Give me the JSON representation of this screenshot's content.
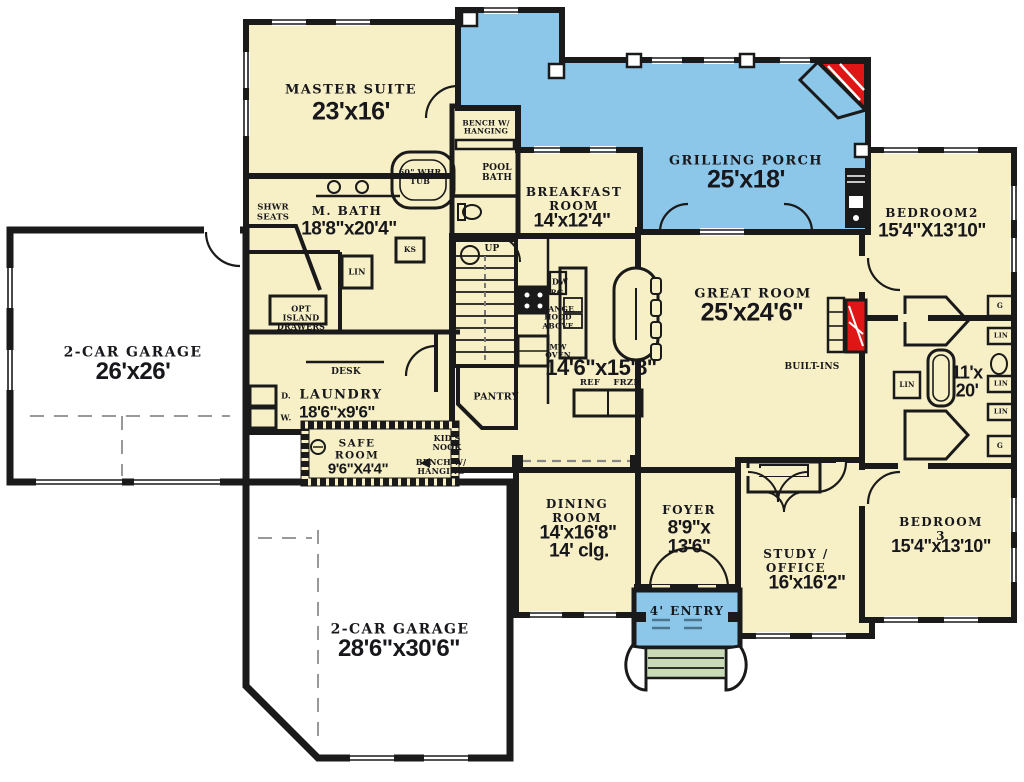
{
  "plan": {
    "rooms": {
      "master": {
        "name": "MASTER SUITE",
        "dims": "23'x16'"
      },
      "mbath": {
        "name": "M. BATH",
        "dims": "18'8\"x20'4\""
      },
      "garage1": {
        "name": "2-CAR GARAGE",
        "dims": "26'x26'"
      },
      "laundry": {
        "name": "LAUNDRY",
        "dims": "18'6\"x9'6\""
      },
      "safe": {
        "name": "SAFE\nROOM",
        "dims": "9'6\"X4'4\""
      },
      "garage2": {
        "name": "2-CAR GARAGE",
        "dims": "28'6\"x30'6\""
      },
      "breakfast": {
        "name": "BREAKFAST\nROOM",
        "dims": "14'x12'4\""
      },
      "porch": {
        "name": "GRILLING PORCH",
        "dims": "25'x18'"
      },
      "great": {
        "name": "GREAT ROOM",
        "dims": "25'x24'6\""
      },
      "kitchen": {
        "dims": "14'6\"x15'8\""
      },
      "dining": {
        "name": "DINING\nROOM",
        "dims": "14'x16'8\"",
        "ceiling": "14' clg."
      },
      "foyer": {
        "name": "FOYER",
        "dims": "8'9\"x\n13'6\""
      },
      "study": {
        "name": "STUDY /\nOFFICE",
        "dims": "16'x16'2\""
      },
      "bedroom2": {
        "name": "BEDROOM2",
        "dims": "15'4\"X13'10\""
      },
      "jjbath": {
        "dims": "11'x\n20'"
      },
      "bedroom3": {
        "name": "BEDROOM 3",
        "dims": "15'4\"x13'10\""
      },
      "entry": {
        "name": "4' ENTRY"
      }
    },
    "annotations": {
      "shwr_seats": "SHWR\nSEATS",
      "whr_tub": "60\" WHR\nTUB",
      "lin_hall": "LIN",
      "ks": "KS",
      "opt_island": "OPT\nISLAND\nDRAWERS",
      "desk": "DESK",
      "dryer": "D.",
      "washer": "W.",
      "kids_nook": "KID'S\nNOOK",
      "bench_hanging_mud": "BENCH W/\nHANGING",
      "bench_hanging_top": "BENCH W/\nHANGING",
      "pool_bath": "POOL\nBATH",
      "up": "UP",
      "dw": "DW",
      "rg": "RG",
      "range_hood": "RANGE\nHOOD\nABOVE",
      "mw_oven": "MW\nOVEN",
      "ref": "REF",
      "frzr": "FRZR",
      "pantry": "PANTRY",
      "builtins": "BUILT-INS",
      "g_top": "G",
      "g_bottom": "G",
      "lin_1": "LIN",
      "lin_2": "LIN",
      "lin_3": "LIN",
      "lin_bath": "LIN"
    },
    "colors": {
      "floor": "#f7f0c6",
      "porch": "#8cc7ea",
      "steps": "#c8dab6",
      "wall": "#1a1a1a",
      "accent_red": "#e01616",
      "garage": "#ffffff"
    }
  }
}
